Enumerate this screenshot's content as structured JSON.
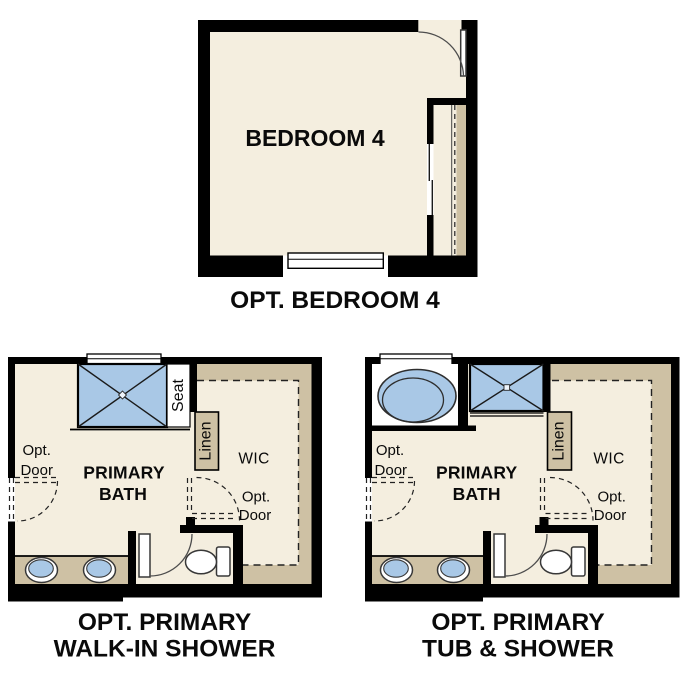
{
  "page": {
    "background": "#ffffff"
  },
  "colors": {
    "wall": "#000000",
    "floor": "#f4eedf",
    "closet_shelf_tan": "#cec1a4",
    "fixture_blue": "#a9c8e6",
    "fixture_outline": "#383838",
    "text": "#0a0a0a"
  },
  "plans": [
    {
      "id": "opt-bedroom-4",
      "caption_lines": [
        "OPT. BEDROOM 4"
      ],
      "room_label": "BEDROOM 4"
    },
    {
      "id": "opt-primary-walk-in-shower",
      "caption_lines": [
        "OPT. PRIMARY",
        "WALK-IN SHOWER"
      ],
      "room_lines": [
        "PRIMARY",
        "BATH"
      ],
      "wic": "WIC",
      "linen": "Linen",
      "seat": "Seat",
      "opt_door_entry": {
        "line1": "Opt.",
        "line2": "Door"
      },
      "opt_door_wic": {
        "line1": "Opt.",
        "line2": "Door"
      }
    },
    {
      "id": "opt-primary-tub-and-shower",
      "caption_lines": [
        "OPT. PRIMARY",
        "TUB & SHOWER"
      ],
      "room_lines": [
        "PRIMARY",
        "BATH"
      ],
      "wic": "WIC",
      "linen": "Linen",
      "opt_door_entry": {
        "line1": "Opt.",
        "line2": "Door"
      },
      "opt_door_wic": {
        "line1": "Opt.",
        "line2": "Door"
      }
    }
  ]
}
